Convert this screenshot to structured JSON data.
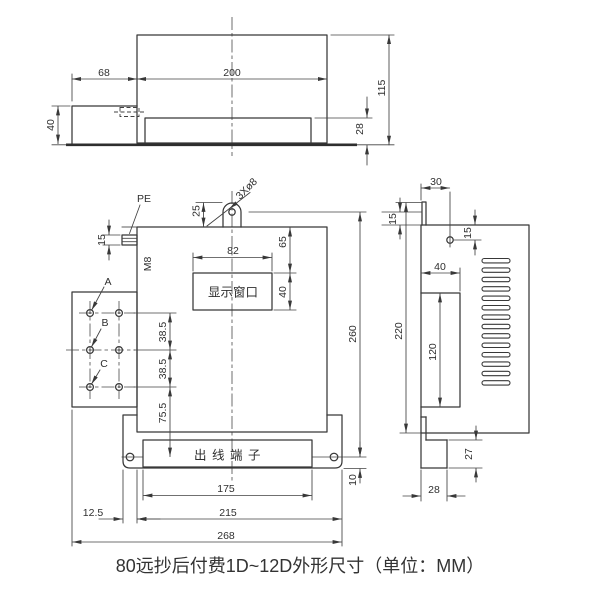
{
  "caption": "80远抄后付费1D~12D外形尺寸（单位：MM）",
  "top_view": {
    "d68": "68",
    "d200": "200",
    "d115": "115",
    "d40": "40",
    "d28": "28"
  },
  "front_view": {
    "label_pe": "PE",
    "label_m8": "M8",
    "label_holes": "3Xø8",
    "label_a": "A",
    "label_b": "B",
    "label_c": "C",
    "display_window": "显示窗口",
    "outlet_terminal": "出线端子",
    "d25": "25",
    "d15": "15",
    "d82": "82",
    "d65": "65",
    "d40": "40",
    "d38_top": "38.5",
    "d38_bottom": "38.5",
    "d75": "75.5",
    "d260": "260",
    "d10": "10",
    "d175": "175",
    "d215": "215",
    "d268": "268",
    "d12": "12.5"
  },
  "side_view": {
    "d30": "30",
    "d15_left": "15",
    "d15_right": "15",
    "d40": "40",
    "d120": "120",
    "d220": "220",
    "d27": "27",
    "d28": "28"
  }
}
